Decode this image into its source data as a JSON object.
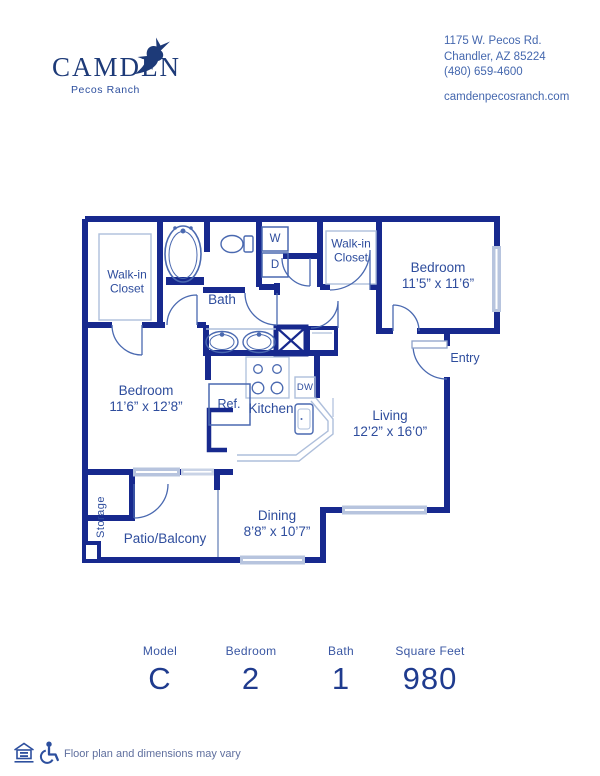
{
  "header": {
    "logo": {
      "brand": "CAMDEN",
      "community": "Pecos Ranch"
    },
    "contact": {
      "line1": "1175 W. Pecos Rd.",
      "line2": "Chandler, AZ 85224",
      "line3": "(480) 659-4600",
      "website": "camdenpecosranch.com"
    }
  },
  "floorplan": {
    "rooms": {
      "walk_in_closet_1": {
        "line1": "Walk-in",
        "line2": "Closet"
      },
      "walk_in_closet_2": {
        "line1": "Walk-in",
        "line2": "Closet"
      },
      "bath": {
        "label": "Bath"
      },
      "bedroom_2": {
        "label": "Bedroom",
        "dims": "11’5” x 11’6”"
      },
      "entry": {
        "label": "Entry"
      },
      "bedroom_1": {
        "label": "Bedroom",
        "dims": "11’6” x 12’8”"
      },
      "kitchen": {
        "label": "Kitchen"
      },
      "living": {
        "label": "Living",
        "dims": "12’2” x 16’0”"
      },
      "storage": {
        "label": "Storage"
      },
      "patio": {
        "label": "Patio/Balcony"
      },
      "dining": {
        "label": "Dining",
        "dims": "8’8” x 10’7”"
      }
    },
    "appliances": {
      "washer": "W",
      "dryer": "D",
      "refrigerator": "Ref.",
      "dishwasher": "DW"
    }
  },
  "stats": [
    {
      "label": "Model",
      "value": "C"
    },
    {
      "label": "Bedroom",
      "value": "2"
    },
    {
      "label": "Bath",
      "value": "1"
    },
    {
      "label": "Square Feet",
      "value": "980"
    }
  ],
  "footer": {
    "disclaimer": "Floor plan and dimensions may vary"
  },
  "colors": {
    "wall": "#17298e",
    "fixture": "#4a69b0",
    "light": "#aebfdb",
    "label": "#2e4d9d"
  }
}
